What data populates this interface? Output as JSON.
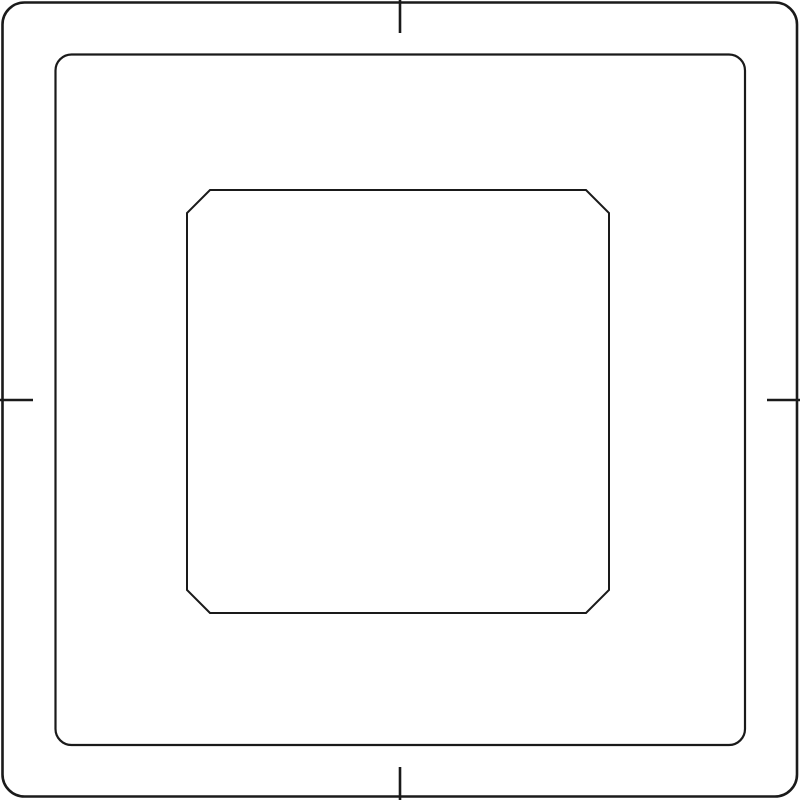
{
  "canvas": {
    "width": 800,
    "height": 800,
    "background_color": "#ffffff",
    "stroke_color": "#1a1a1a",
    "description": "stencil-template line drawing with registration tick marks"
  },
  "shapes": {
    "outer_frame": {
      "kind": "rounded-square-outline",
      "x": 2.5,
      "y": 2.5,
      "width": 794.5,
      "height": 794,
      "corner_radius": 22,
      "path": "M 24.5 2.5 L 775 2.5 A 22 22 0 0 1 797 24.5 L 797 774.5 A 22 22 0 0 1 775 796.5 L 24.5 796.5 A 22 22 0 0 1 2.5 774.5 L 2.5 24.5 A 22 22 0 0 1 24.5 2.5 Z"
    },
    "inner_frame": {
      "kind": "rounded-square-outline",
      "x": 55.5,
      "y": 54.5,
      "width": 689.5,
      "height": 690.5,
      "corner_radius": 16,
      "path": "M 71.5 54.5 L 729 54.5 A 16 16 0 0 1 745 70.5 L 745 729 A 16 16 0 0 1 729 745 L 71.5 745 A 16 16 0 0 1 55.5 729 L 55.5 70.5 A 16 16 0 0 1 71.5 54.5 Z"
    },
    "center_octagon": {
      "kind": "chamfered-square-outline",
      "left": 187,
      "top": 190,
      "right": 609,
      "bottom": 613,
      "chamfer": 23,
      "points": "210,190 586,190 609,213 609,590 586,613 210,613 187,590 187,213"
    }
  },
  "tick_marks": {
    "length": 33,
    "top": {
      "path": "M 400 0 L 400 33"
    },
    "bottom": {
      "path": "M 400 800 L 400 767"
    },
    "left": {
      "path": "M 0 400 L 33 400"
    },
    "right": {
      "path": "M 800 400 L 767 400"
    }
  }
}
